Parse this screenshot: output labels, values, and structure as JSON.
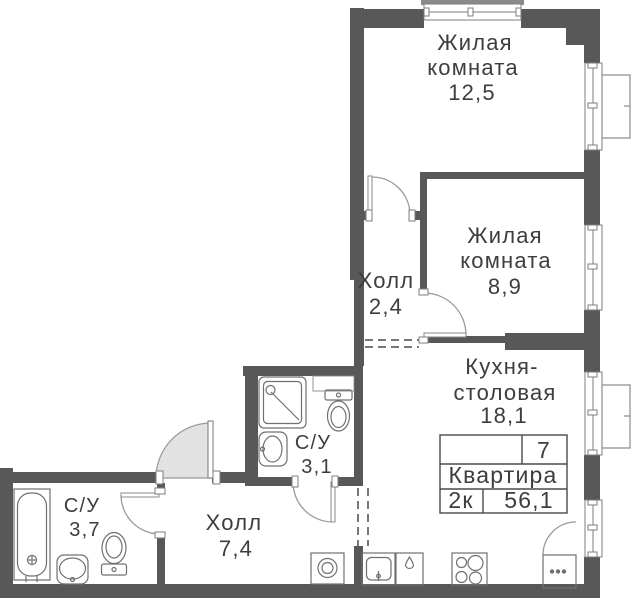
{
  "plan": {
    "rooms": {
      "living1": {
        "name_line1": "Жилая",
        "name_line2": "комната",
        "area": "12,5"
      },
      "living2": {
        "name_line1": "Жилая",
        "name_line2": "комната",
        "area": "8,9"
      },
      "hall_small": {
        "name": "Холл",
        "area": "2,4"
      },
      "kitchen": {
        "name_line1": "Кухня-",
        "name_line2": "столовая",
        "area": "18,1"
      },
      "bathroom_small": {
        "name": "С/У",
        "area": "3,1"
      },
      "bathroom_large": {
        "name": "С/У",
        "area": "3,7"
      },
      "hall_main": {
        "name": "Холл",
        "area": "7,4"
      }
    },
    "stamp": {
      "floor_number": "7",
      "title": "Квартира",
      "rooms_count": "2к",
      "total_area": "56,1"
    },
    "colors": {
      "wall": "#585858",
      "fixture_line": "#707070",
      "text": "#3d3d3d",
      "door_fill": "#e2e2e2"
    }
  }
}
